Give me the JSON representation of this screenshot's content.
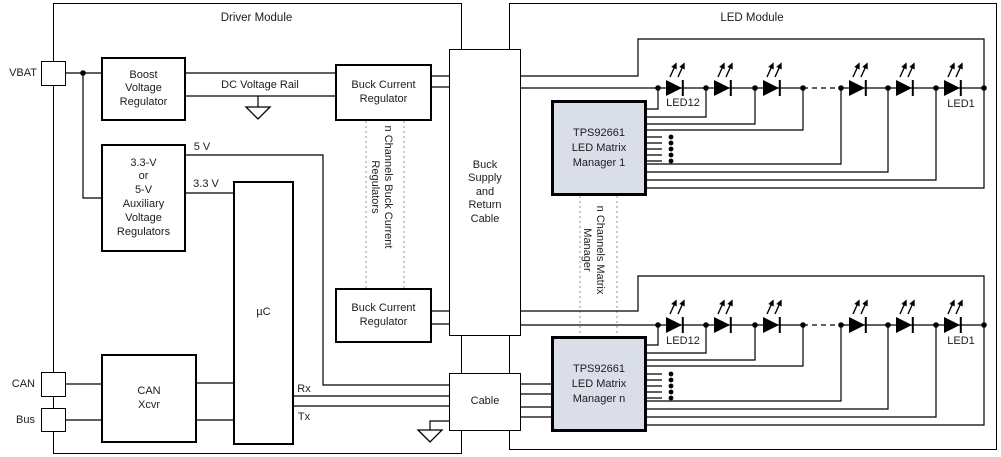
{
  "modules": {
    "driver": {
      "title": "Driver Module"
    },
    "led": {
      "title": "LED Module"
    }
  },
  "ports": {
    "vbat": "VBAT",
    "can": "CAN",
    "bus": "Bus"
  },
  "blocks": {
    "boost": {
      "lines": [
        "Boost",
        "Voltage",
        "Regulator"
      ]
    },
    "aux": {
      "lines": [
        "3.3-V",
        "or",
        "5-V",
        "Auxiliary",
        "Voltage",
        "Regulators"
      ]
    },
    "uc": {
      "label": "µC"
    },
    "can_xcvr": {
      "lines": [
        "CAN",
        "Xcvr"
      ]
    },
    "buck_top": {
      "lines": [
        "Buck Current",
        "Regulator"
      ]
    },
    "buck_bottom": {
      "lines": [
        "Buck Current",
        "Regulator"
      ]
    },
    "buck_supply": {
      "lines": [
        "Buck",
        "Supply",
        "and",
        "Return",
        "Cable"
      ]
    },
    "cable": {
      "label": "Cable"
    },
    "tps1": {
      "lines": [
        "TPS92661",
        "LED Matrix",
        "Manager 1"
      ]
    },
    "tpsn": {
      "lines": [
        "TPS92661",
        "LED Matrix",
        "Manager n"
      ]
    }
  },
  "wire_labels": {
    "dc_rail": "DC Voltage Rail",
    "v5": "5 V",
    "v33": "3.3 V",
    "rx": "Rx",
    "tx": "Tx"
  },
  "rotated_labels": {
    "buck_channels": "n Channels Buck Current\nRegulators",
    "matrix_channels": "n Channels Matrix\nManager"
  },
  "led_labels": {
    "led12": "LED12",
    "led1": "LED1"
  },
  "icons": {
    "ground": "ground-icon",
    "led": "led-diode-icon",
    "junction": "junction-dot",
    "ellipsis": "vertical-ellipsis-dots"
  },
  "colors": {
    "wire": "#000000",
    "dotted_line": "#9e9e9e",
    "tps_fill": "#d9dee9"
  }
}
